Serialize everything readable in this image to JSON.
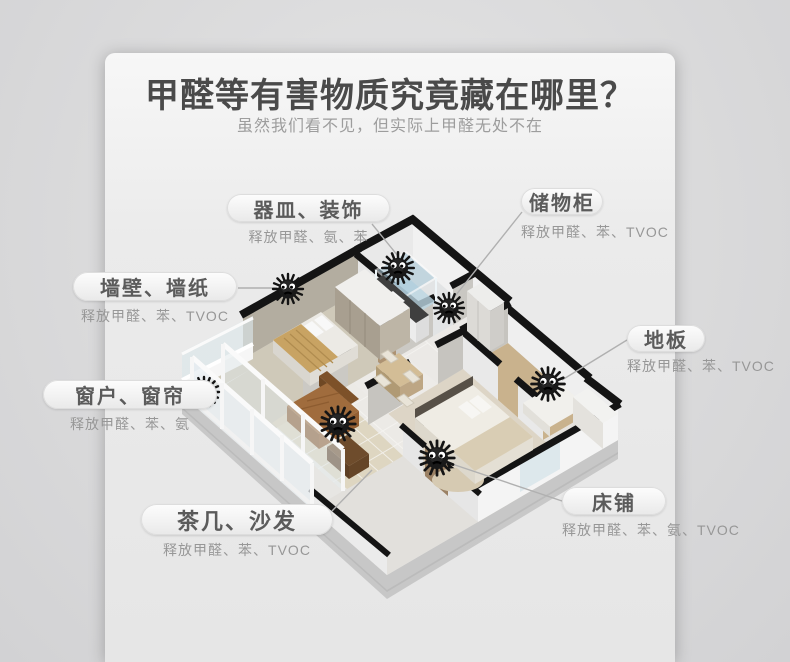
{
  "header": {
    "title": "甲醛等有害物质究竟藏在哪里？",
    "subtitle": "虽然我们看不见，但实际上甲醛无处不在"
  },
  "callouts": [
    {
      "name": "器皿、装饰",
      "emission": "释放甲醛、氨、苯"
    },
    {
      "name": "储物柜",
      "emission": "释放甲醛、苯、TVOC"
    },
    {
      "name": "墙壁、墙纸",
      "emission": "释放甲醛、苯、TVOC"
    },
    {
      "name": "地板",
      "emission": "释放甲醛、苯、TVOC"
    },
    {
      "name": "窗户、窗帘",
      "emission": "释放甲醛、苯、氨"
    },
    {
      "name": "茶几、沙发",
      "emission": "释放甲醛、苯、TVOC"
    },
    {
      "name": "床铺",
      "emission": "释放甲醛、苯、氨、TVOC"
    }
  ],
  "icons": {
    "monster": "formaldehyde-monster"
  },
  "colors": {
    "wall_cap": "#141414",
    "monster_body": "#1c1c1c",
    "pill_text": "#5b5b5b",
    "emission_text": "#979797",
    "connector_line": "#b0b0b0",
    "panel_bg": "#efefef"
  }
}
